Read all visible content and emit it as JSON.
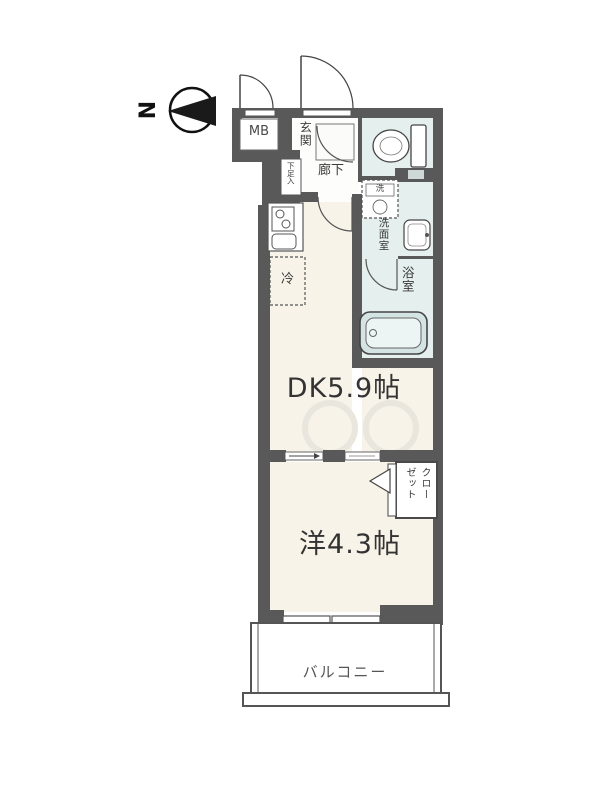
{
  "title": "apartment-floor-plan",
  "compass": {
    "north_label": "N"
  },
  "labels": {
    "meter_box": "MB",
    "entrance": "玄関",
    "hallway": "廊下",
    "shoe_cabinet": "下足入",
    "washer_symbol": "洗",
    "washroom": "洗面室",
    "bathroom": "浴室",
    "refrigerator": "冷",
    "dining_kitchen": "DK5.9帖",
    "western_room": "洋4.3帖",
    "closet_line1": "クロー",
    "closet_line2": "ゼット",
    "balcony": "バルコニー"
  },
  "colors": {
    "wall": "#595959",
    "room_floor": "#f8f3e9",
    "wet_area": "#e4efee",
    "bathtub_fill": "#d3e4e3",
    "text": "#3b3b3b"
  }
}
